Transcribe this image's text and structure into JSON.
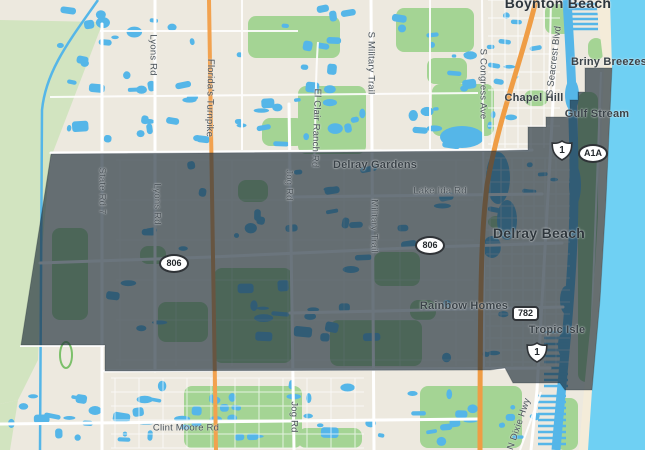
{
  "map": {
    "title": "Delray Beach area map with selected region",
    "colors": {
      "land": "#ede9df",
      "water": "#55b6e8",
      "ocean": "#6fd0f3",
      "park": "#a4d494",
      "park_light": "#d2e4c0",
      "beach": "#f4ecd9",
      "road_white": "#ffffff",
      "highway_orange": "#ef9d45",
      "turnpike_orange": "#f2a24f",
      "overlay": "rgba(30,45,58,0.66)"
    },
    "labels": [
      {
        "id": "boynton-beach",
        "text": "Boynton Beach",
        "x": 558,
        "y": 3,
        "rot": 0,
        "cls": "lbl-city"
      },
      {
        "id": "delray-beach",
        "text": "Delray Beach",
        "x": 539,
        "y": 233,
        "rot": 0,
        "cls": "lbl-city"
      },
      {
        "id": "briny-breezes",
        "text": "Briny Breezes",
        "x": 609,
        "y": 62,
        "rot": 0,
        "cls": "lbl-place"
      },
      {
        "id": "gulf-stream",
        "text": "Gulf Stream",
        "x": 597,
        "y": 114,
        "rot": 0,
        "cls": "lbl-place"
      },
      {
        "id": "chapel-hill",
        "text": "Chapel Hill",
        "x": 534,
        "y": 98,
        "rot": 0,
        "cls": "lbl-place"
      },
      {
        "id": "delray-gardens",
        "text": "Delray Gardens",
        "x": 375,
        "y": 165,
        "rot": 0,
        "cls": "lbl-place"
      },
      {
        "id": "rainbow-homes",
        "text": "Rainbow Homes",
        "x": 464,
        "y": 306,
        "rot": 0,
        "cls": "lbl-place"
      },
      {
        "id": "tropic-isle",
        "text": "Tropic Isle",
        "x": 557,
        "y": 330,
        "rot": 0,
        "cls": "lbl-place"
      },
      {
        "id": "lake-ida-rd",
        "text": "Lake Ida Rd",
        "x": 440,
        "y": 191,
        "rot": 0,
        "cls": "lbl-road"
      },
      {
        "id": "clint-moore-rd",
        "text": "Clint Moore Rd",
        "x": 186,
        "y": 428,
        "rot": 0,
        "cls": "lbl-road"
      },
      {
        "id": "lyons-rd-north",
        "text": "Lyons Rd",
        "x": 153,
        "y": 55,
        "rot": 90,
        "cls": "lbl-road"
      },
      {
        "id": "floridas-turnpike",
        "text": "Florida's Turnpike",
        "x": 210,
        "y": 98,
        "rot": 91,
        "cls": "lbl-road"
      },
      {
        "id": "el-clair-ranch-rd",
        "text": "El Clair Ranch Rd",
        "x": 316,
        "y": 128,
        "rot": 92,
        "cls": "lbl-road"
      },
      {
        "id": "s-military-trail",
        "text": "S Military Trail",
        "x": 371,
        "y": 63,
        "rot": 90,
        "cls": "lbl-road"
      },
      {
        "id": "s-congress-ave",
        "text": "S Congress Ave",
        "x": 483,
        "y": 84,
        "rot": 90,
        "cls": "lbl-road"
      },
      {
        "id": "s-seacrest-blvd",
        "text": "S Seacrest Blvd",
        "x": 554,
        "y": 61,
        "rot": -83,
        "cls": "lbl-road"
      },
      {
        "id": "state-rd-7",
        "text": "State Rd 7",
        "x": 102,
        "y": 191,
        "rot": 90,
        "cls": "lbl-road"
      },
      {
        "id": "lyons-rd-south",
        "text": "Lyons Rd",
        "x": 157,
        "y": 204,
        "rot": 90,
        "cls": "lbl-road"
      },
      {
        "id": "jog-rd-north",
        "text": "Jog Rd",
        "x": 289,
        "y": 185,
        "rot": 90,
        "cls": "lbl-road"
      },
      {
        "id": "military-trail",
        "text": "Military Trail",
        "x": 374,
        "y": 226,
        "rot": 90,
        "cls": "lbl-road"
      },
      {
        "id": "jog-rd-south",
        "text": "Jog Rd",
        "x": 294,
        "y": 417,
        "rot": 90,
        "cls": "lbl-road"
      },
      {
        "id": "n-dixie-hwy",
        "text": "N Dixie Hwy",
        "x": 519,
        "y": 424,
        "rot": -71,
        "cls": "lbl-road"
      }
    ],
    "shields": [
      {
        "id": "route-806-west",
        "type": "ellipse",
        "text": "806",
        "x": 174,
        "y": 263
      },
      {
        "id": "route-806-east",
        "type": "ellipse",
        "text": "806",
        "x": 430,
        "y": 245
      },
      {
        "id": "route-782",
        "type": "rect",
        "text": "782",
        "x": 525,
        "y": 313
      },
      {
        "id": "us-1-north",
        "type": "us",
        "text": "1",
        "x": 562,
        "y": 150
      },
      {
        "id": "us-1-south",
        "type": "us",
        "text": "1",
        "x": 537,
        "y": 352
      },
      {
        "id": "route-a1a",
        "type": "ellipse",
        "text": "A1A",
        "x": 593,
        "y": 153
      }
    ]
  }
}
